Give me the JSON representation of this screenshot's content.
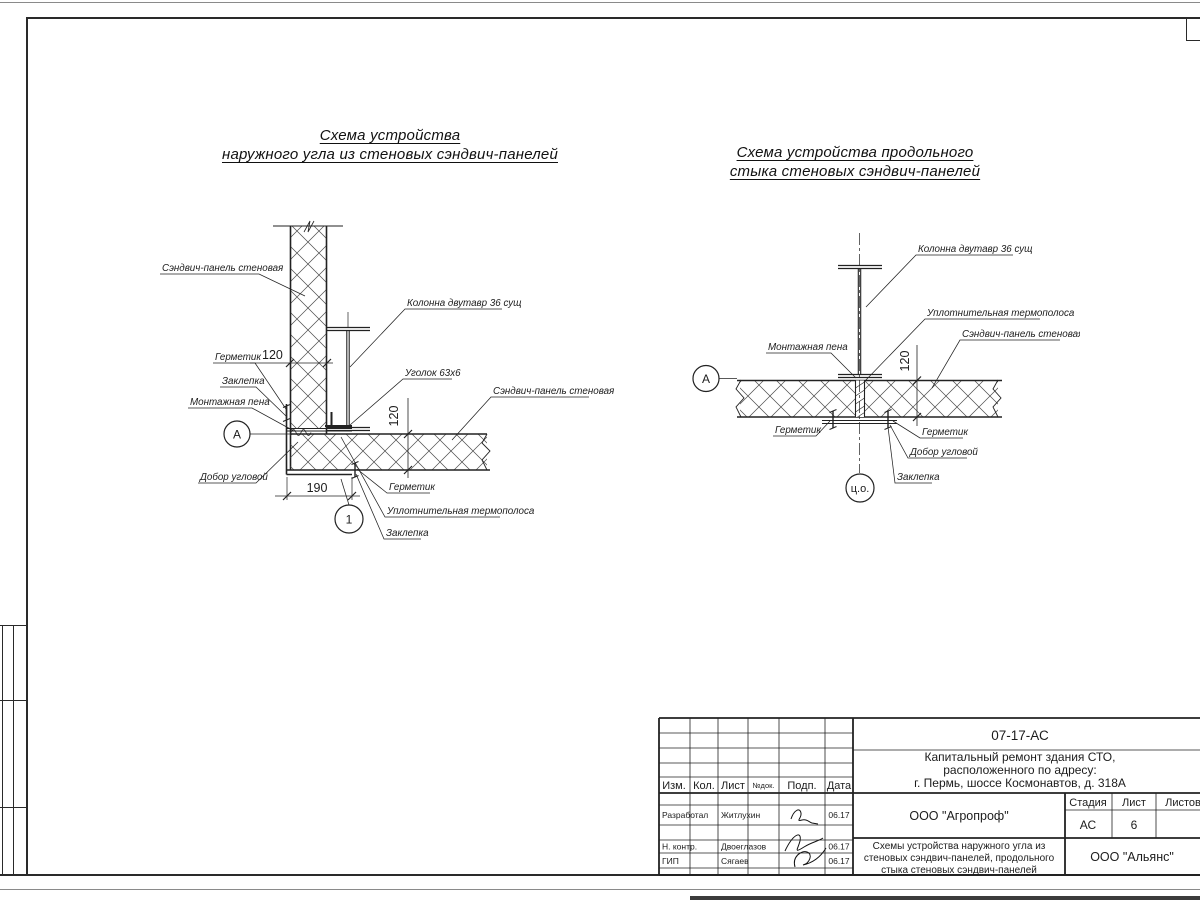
{
  "titles": {
    "left": [
      "Схема устройства",
      "наружного угла из стеновых сэндвич-панелей"
    ],
    "right": [
      "Схема устройства продольного",
      "стыка стеновых сэндвич-панелей"
    ]
  },
  "left_detail": {
    "panel_label": "Сэндвич-панель стеновая",
    "column_label": "Колонна двутавр 36 сущ",
    "angle_label": "Уголок 63х6",
    "panel_right_label": "Сэндвич-панель стеновая",
    "sealant_label": "Герметик",
    "rivet_label": "Заклепка",
    "foam_label": "Монтажная пена",
    "corner_trim_label": "Добор угловой",
    "sealant2_label": "Герметик",
    "thermal_label": "Уплотнительная термополоса",
    "rivet2_label": "Заклепка",
    "dim_panel_thickness": "120",
    "dim_bottom_thickness": "120",
    "dim_corner_width": "190",
    "node_marker": "А",
    "detail_marker": "1"
  },
  "right_detail": {
    "column_label": "Колонна двутавр 36 сущ",
    "thermal_label": "Уплотнительная термополоса",
    "panel_label": "Сэндвич-панель стеновая",
    "foam_label": "Монтажная пена",
    "sealant_left_label": "Герметик",
    "sealant_right_label": "Герметик",
    "corner_trim_label": "Добор угловой",
    "rivet_label": "Заклепка",
    "dim_thickness": "120",
    "node_marker": "А",
    "center_marker": "ц.о."
  },
  "titleblock": {
    "doc_number": "07-17-АС",
    "project_line1": "Капитальный ремонт здания СТО,",
    "project_line2": "расположенного по адресу:",
    "project_line3": "г. Пермь, шоссе Космонавтов, д. 318А",
    "columns": {
      "izm": "Изм.",
      "kol": "Кол.",
      "list": "Лист",
      "ndok": "№док.",
      "podp": "Подп.",
      "data": "Дата"
    },
    "stage_header": "Стадия",
    "sheet_header": "Лист",
    "sheets_header": "Листов",
    "stage_value": "АС",
    "sheet_value": "6",
    "org_design": "ООО \"Агропроф\"",
    "org_customer": "ООО \"Альянс\"",
    "sheet_name_line1": "Схемы устройства наружного угла из",
    "sheet_name_line2": "стеновых сэндвич-панелей, продольного",
    "sheet_name_line3": "стыка стеновых сэндвич-панелей",
    "rows": [
      {
        "role": "Разработал",
        "name": "Житлухин",
        "date": "06.17"
      },
      {
        "role": "Н. контр.",
        "name": "Двоеглазов",
        "date": "06.17"
      },
      {
        "role": "ГИП",
        "name": "Сягаев",
        "date": "06.17"
      }
    ]
  }
}
